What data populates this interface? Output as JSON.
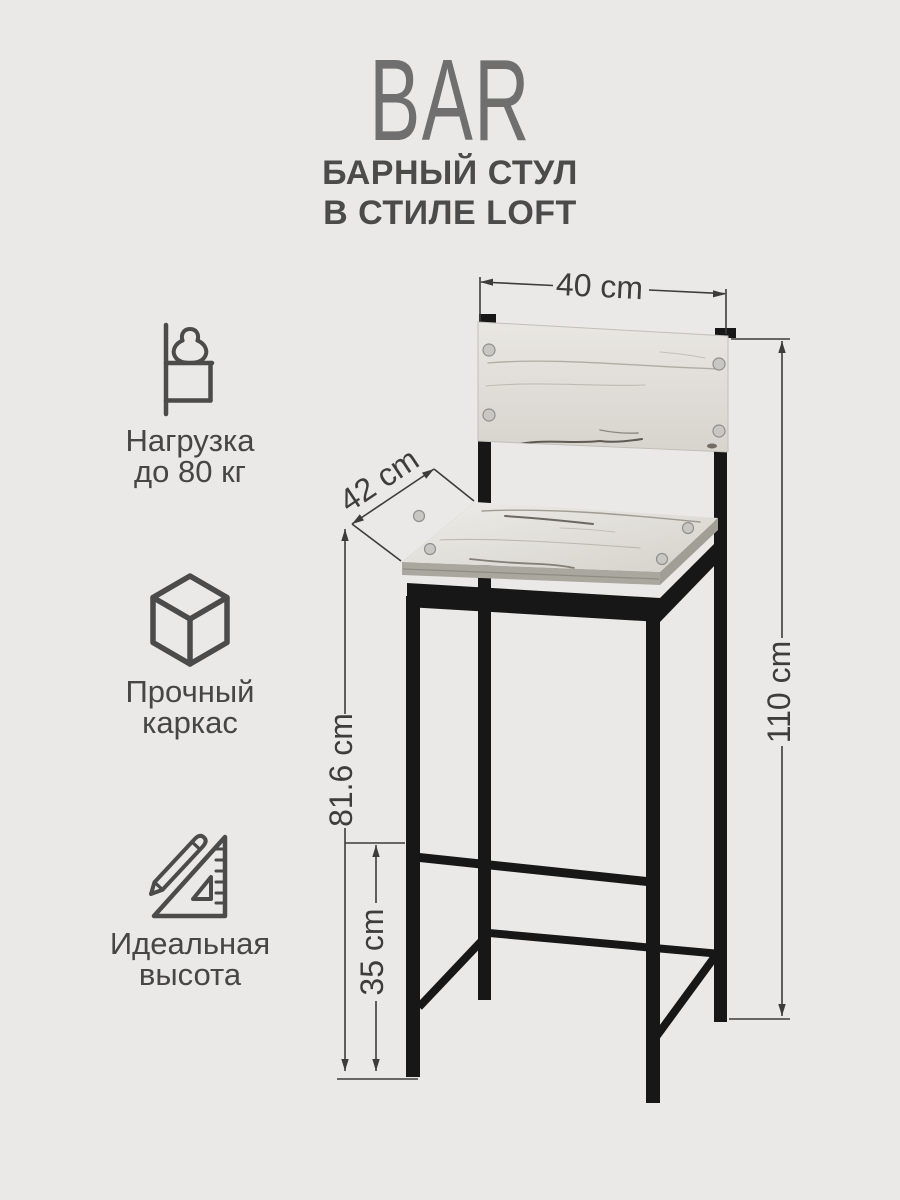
{
  "page": {
    "background_color": "#eae9e7"
  },
  "header": {
    "title": "BAR",
    "subtitle_line1": "БАРНЫЙ СТУЛ",
    "subtitle_line2": "В СТИЛЕ LOFT"
  },
  "features": [
    {
      "icon": "kettlebell-stand-icon",
      "label_line1": "Нагрузка",
      "label_line2": "до 80 кг"
    },
    {
      "icon": "cube-icon",
      "label_line1": "Прочный",
      "label_line2": "каркас"
    },
    {
      "icon": "set-square-pencil-icon",
      "label_line1": "Идеальная",
      "label_line2": "высота"
    }
  ],
  "dimensions": {
    "backrest_width": "40 cm",
    "seat_depth": "42 cm",
    "total_height": "110 cm",
    "seat_height": "81.6 cm",
    "footrest_height": "35 cm"
  },
  "colors": {
    "metal": "#171717",
    "wood_light": "#e0ded8",
    "wood_edge": "#a9a69d",
    "label_text": "#464646",
    "title_gray": "#6f6f6f",
    "dimension_line": "#3c3c3c"
  }
}
